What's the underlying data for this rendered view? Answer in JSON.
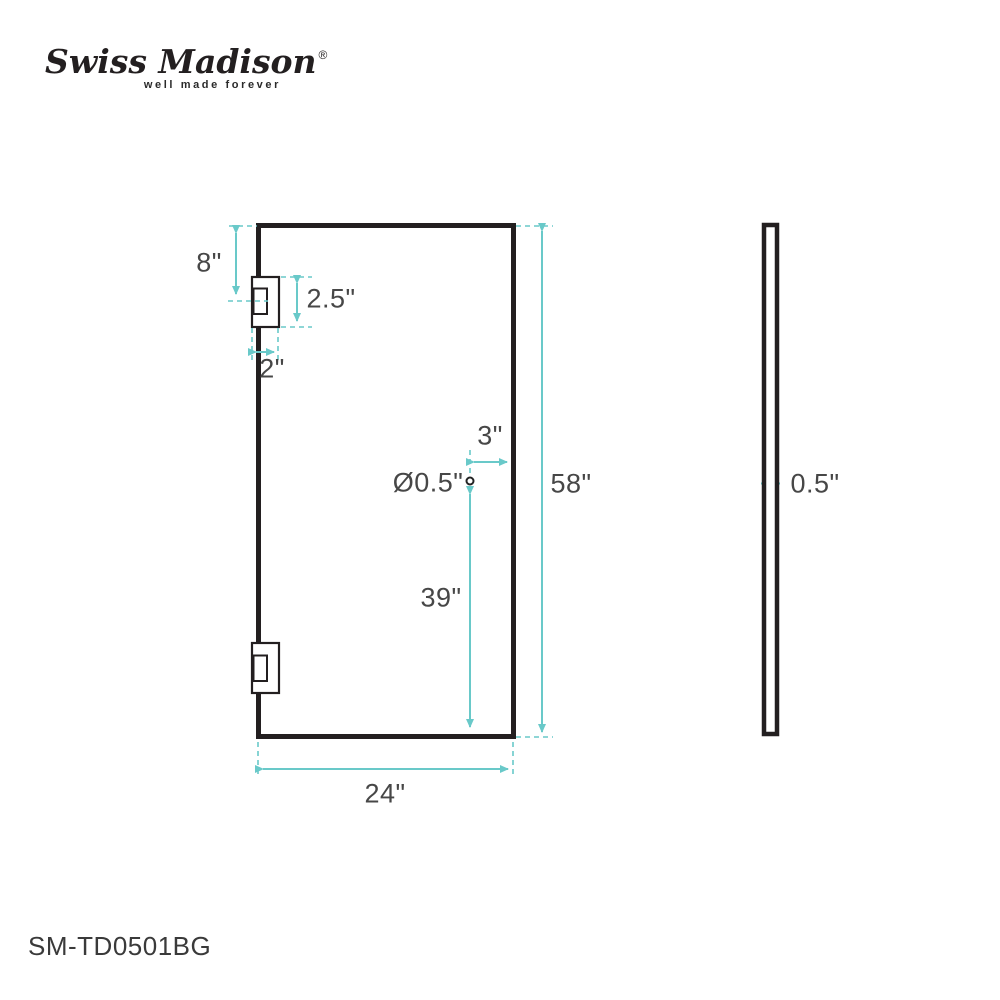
{
  "logo": {
    "brand": "Swiss Madison",
    "registered": "®",
    "tagline": "well made forever"
  },
  "part_number": "SM-TD0501BG",
  "colors": {
    "dimension_accent": "#69c9c9",
    "drawing_line": "#231f20",
    "label_text": "#474747"
  },
  "front_view": {
    "name": "glass door front view",
    "dimensions": {
      "hinge_top_offset": "8\"",
      "hinge_height": "2.5\"",
      "hinge_width": "2\"",
      "hole_edge_offset": "3\"",
      "hole_diameter": "Ø0.5\"",
      "door_height": "58\"",
      "hole_bottom_offset": "39\"",
      "door_width": "24\""
    }
  },
  "side_view": {
    "name": "glass panel side view",
    "dimensions": {
      "thickness": "0.5\""
    }
  }
}
